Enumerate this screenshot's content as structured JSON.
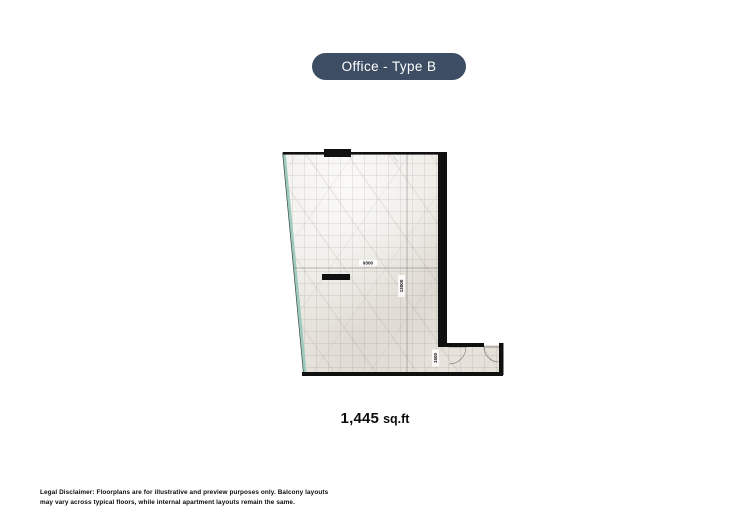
{
  "header": {
    "badge_label": "Office - Type B"
  },
  "floorplan": {
    "dim_width": "9300",
    "dim_height": "13000",
    "dim_corridor": "1500"
  },
  "area": {
    "value": "1,445",
    "unit": "sq.ft"
  },
  "footer": {
    "disclaimer_line1": "Legal Disclaimer: Floorplans are for illustrative and preview purposes only. Balcony layouts",
    "disclaimer_line2": "may vary across typical floors, while internal apartment layouts remain the same."
  },
  "colors": {
    "badge_bg": "#3d4d63",
    "badge_text": "#ffffff",
    "wall": "#101010",
    "glass_wall": "#9fcabe",
    "floor": "#ebe8e2"
  }
}
